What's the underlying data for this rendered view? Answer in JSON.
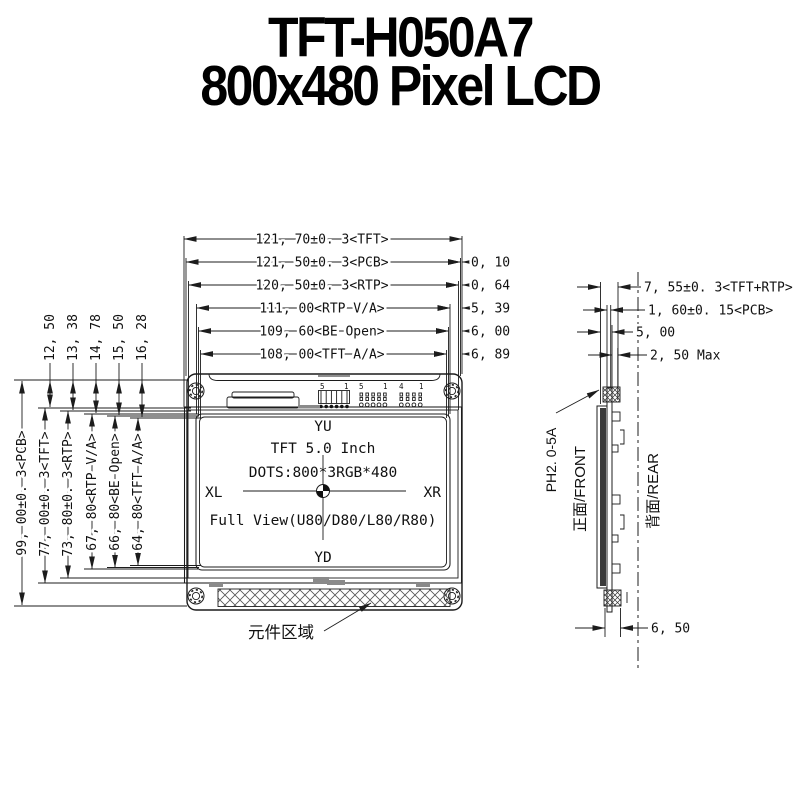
{
  "title": {
    "line1": "TFT-H050A7",
    "line2": "800x480 Pixel LCD"
  },
  "dims": {
    "top": [
      "121, 70±0. 3<TFT>",
      "121, 50±0. 3<PCB>",
      "120, 50±0. 3<RTP>",
      "111, 00<RTP V/A>",
      "109, 60<BE Open>",
      "108, 00<TFT A/A>"
    ],
    "right_offsets": [
      "0, 10",
      "0, 64",
      "5, 39",
      "6, 00",
      "6, 89"
    ],
    "left_small": [
      "12, 50",
      "13, 38",
      "14, 78",
      "15, 50",
      "16, 28"
    ],
    "left_main": [
      "99, 00±0. 3<PCB>",
      "77, 00±0. 3<TFT>",
      "73, 80±0. 3<RTP>",
      "67, 80<RTP V/A>",
      "66, 80<BE Open>",
      "64, 80<TFT A/A>"
    ],
    "side": [
      "7, 55±0. 3<TFT+RTP>",
      "1, 60±0. 15<PCB>",
      "5, 00",
      "2, 50 Max"
    ],
    "side_bottom": "6, 50"
  },
  "front_view": {
    "screen": {
      "top": "YU",
      "line1": "TFT 5.0 Inch",
      "line2": "DOTS:800*3RGB*480",
      "left": "XL",
      "right": "XR",
      "line3": "Full View(U80/D80/L80/R80)",
      "bottom": "YD"
    },
    "pins": {
      "h1_start": "5",
      "h1_end": "1",
      "h2_start": "5",
      "h2_end": "1",
      "h3_start": "4",
      "h3_end": "1"
    },
    "component_area": "元件区域"
  },
  "side_view": {
    "connector": "PH2. 0-5A",
    "front": "正面/FRONT",
    "rear": "背面/REAR"
  },
  "colors": {
    "line": "#1c1c1c",
    "glass_fill": "#3a3a3a",
    "tab_gray": "#8a8a8a",
    "background": "#ffffff"
  }
}
